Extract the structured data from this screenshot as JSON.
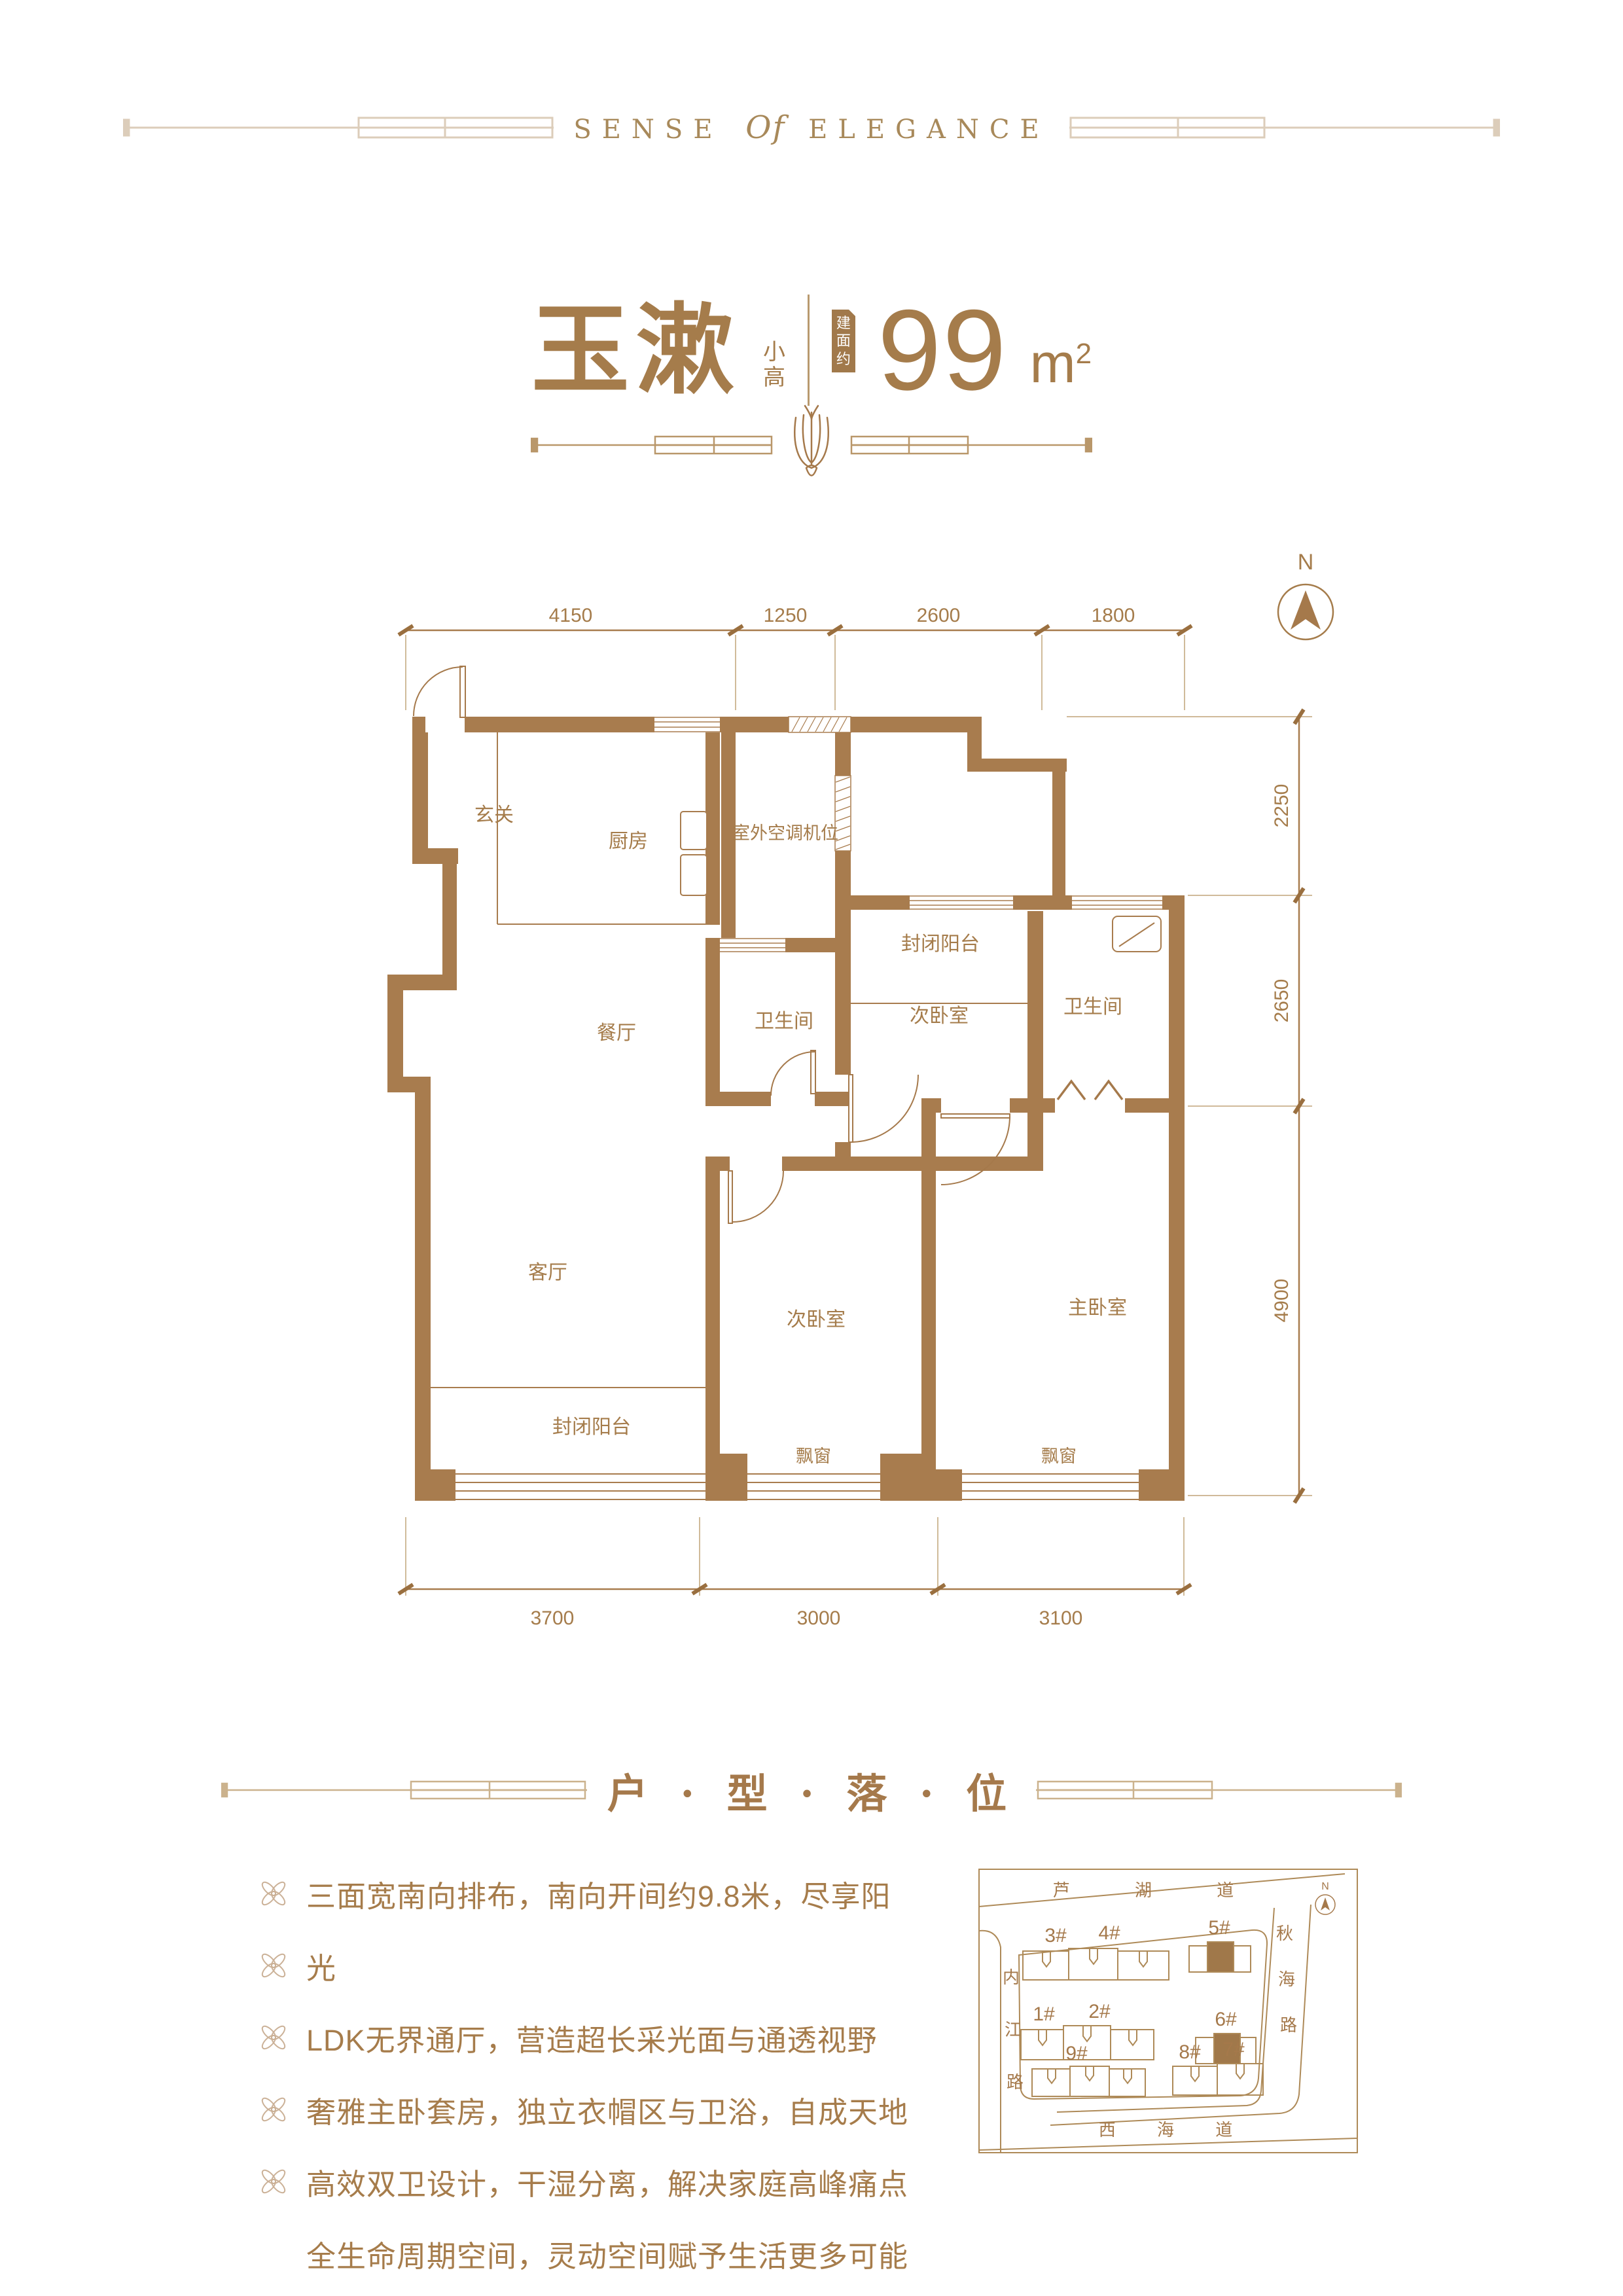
{
  "header": {
    "brand_left": "SENSE",
    "brand_mid": "Of",
    "brand_right": "ELEGANCE"
  },
  "unit": {
    "name": "玉漱",
    "type_tag_1": "小",
    "type_tag_2": "高",
    "area_badge_1": "建",
    "area_badge_2": "面",
    "area_badge_3": "约",
    "area_value": "99",
    "area_unit": "m",
    "area_unit_sup": "2"
  },
  "colors": {
    "gold_text": "#A57C4B",
    "wall": "#A87C4E",
    "light_line": "#DCCDBA",
    "divider_line": "#B9976A",
    "map_line": "#AE8A58",
    "badge_bg": "#A1794B",
    "bullet_icon": "#CBB197"
  },
  "floor_plan": {
    "north_label": "N",
    "rooms": [
      {
        "label": "玄关"
      },
      {
        "label": "厨房"
      },
      {
        "label": "室外空调机位"
      },
      {
        "label": "餐厅"
      },
      {
        "label": "卫生间"
      },
      {
        "label": "封闭阳台"
      },
      {
        "label": "次卧室"
      },
      {
        "label": "卫生间"
      },
      {
        "label": "客厅"
      },
      {
        "label": "次卧室"
      },
      {
        "label": "主卧室"
      },
      {
        "label": "封闭阳台"
      },
      {
        "label": "飘窗"
      },
      {
        "label": "飘窗"
      }
    ],
    "dims_top": [
      "4150",
      "1250",
      "2600",
      "1800"
    ],
    "dims_right": [
      "2250",
      "2650",
      "4900"
    ],
    "dims_bottom": [
      "3700",
      "3000",
      "3100"
    ]
  },
  "section": {
    "title": "户 · 型 · 落 · 位"
  },
  "features": {
    "items": [
      {
        "text": "三面宽南向排布，南向开间约9.8米，尽享阳"
      },
      {
        "text": "光"
      },
      {
        "text": "LDK无界通厅，营造超长采光面与通透视野"
      },
      {
        "text": "奢雅主卧套房，独立衣帽区与卫浴，自成天地"
      },
      {
        "text": "高效双卫设计，干湿分离，解决家庭高峰痛点"
      },
      {
        "text": "全生命周期空间，灵动空间赋予生活更多可能"
      }
    ]
  },
  "site_map": {
    "north_label": "N",
    "roads": {
      "top": "芦 湖 道",
      "left_1": "内",
      "left_2": "江",
      "left_3": "路",
      "right_1": "秋",
      "right_2": "海",
      "right_3": "路",
      "bottom": "西  海  道"
    },
    "buildings": [
      {
        "label": "3#"
      },
      {
        "label": "4#"
      },
      {
        "label": "5#"
      },
      {
        "label": "1#"
      },
      {
        "label": "2#"
      },
      {
        "label": "6#"
      },
      {
        "label": "9#"
      },
      {
        "label": "8#"
      },
      {
        "label": "7#"
      }
    ]
  }
}
